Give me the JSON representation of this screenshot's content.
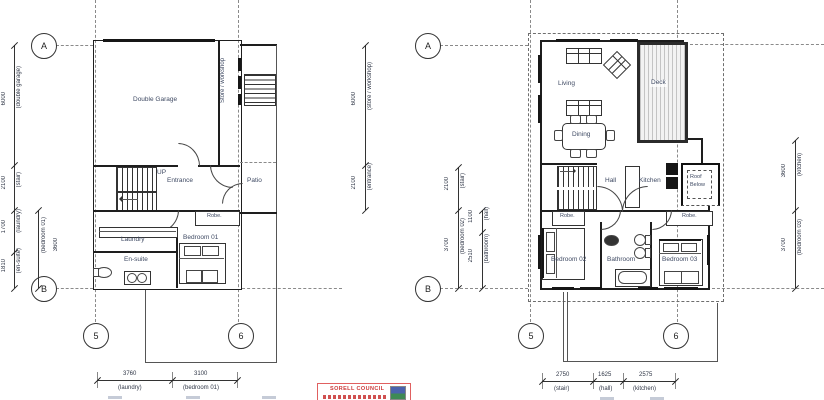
{
  "grid": {
    "a": "A",
    "b": "B",
    "c5": "5",
    "c6": "6"
  },
  "stamp": {
    "line1": "SORELL COUNCIL"
  },
  "ground_floor": {
    "rooms": {
      "garage": "Double Garage",
      "store": "Store / workshop",
      "up": "UP",
      "entrance": "Entrance",
      "patio": "Patio",
      "robe": "Robe.",
      "laundry": "Laundry",
      "ensuite": "En-suite",
      "bedroom01": "Bedroom 01"
    },
    "dims": {
      "left": [
        {
          "v": "6000",
          "l": "(double garage)"
        },
        {
          "v": "2100",
          "l": "(stair)"
        },
        {
          "v": "1700",
          "l": "(laundry)"
        },
        {
          "v": "1810",
          "l": "(en-suite)"
        }
      ],
      "left_inner": [
        {
          "v": "3600",
          "l": "(bedroom 01)"
        }
      ],
      "right": [
        {
          "v": "6000",
          "l": "(store / workshop)"
        },
        {
          "v": "2100",
          "l": "(entrance)"
        }
      ],
      "bottom": [
        {
          "v": "3760",
          "l": "(laundry)"
        },
        {
          "v": "3100",
          "l": "(bedroom 01)"
        }
      ]
    }
  },
  "first_floor": {
    "rooms": {
      "living": "Living",
      "deck": "Deck",
      "dining": "Dining",
      "hall": "Hall",
      "kitchen": "Kitchen",
      "roof_below": "Roof Below",
      "robe": "Robe.",
      "bedroom02": "Bedroom 02",
      "bathroom": "Bathroom",
      "bedroom03": "Bedroom 03"
    },
    "dims": {
      "left": [
        {
          "v": "2100",
          "l": "(stair)"
        },
        {
          "v": "3700",
          "l": "(bedroom 02)"
        }
      ],
      "left_inner": [
        {
          "v": "1100",
          "l": "(hall)"
        },
        {
          "v": "2510",
          "l": "(bathroom)"
        }
      ],
      "right": [
        {
          "v": "3600",
          "l": "(kitchen)"
        },
        {
          "v": "3700",
          "l": "(bedroom 03)"
        }
      ],
      "bottom": [
        {
          "v": "2750",
          "l": "(stair)"
        },
        {
          "v": "1625",
          "l": "(hall)"
        },
        {
          "v": "2575",
          "l": "(kitchen)"
        }
      ]
    }
  }
}
